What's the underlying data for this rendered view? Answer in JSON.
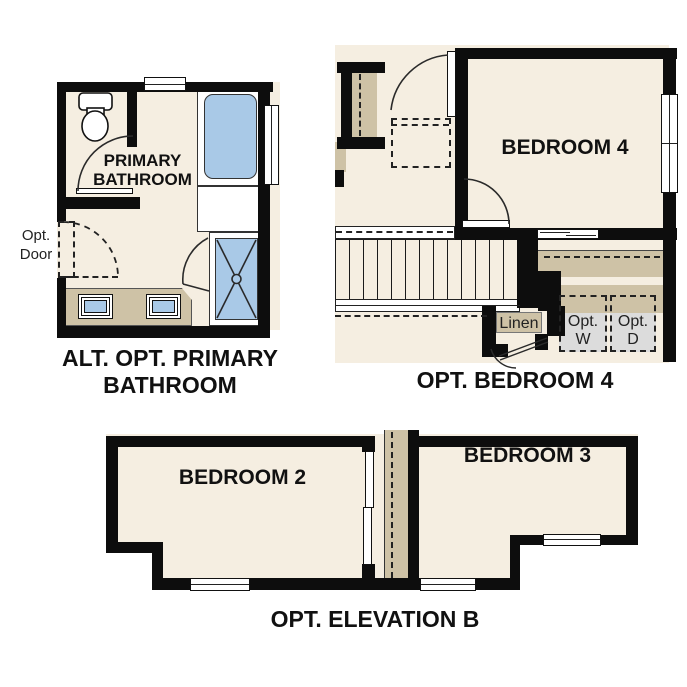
{
  "colors": {
    "floor_cream": "#f5eee1",
    "counter_tan": "#cec2a6",
    "fixture_blue": "#a9c9e7",
    "appliance_gray": "#dcdcdc",
    "wall_black": "#0d0d0d",
    "background": "#ffffff"
  },
  "bathroom_plan": {
    "room_label_line1": "PRIMARY",
    "room_label_line2": "BATHROOM",
    "opt_door_label_line1": "Opt.",
    "opt_door_label_line2": "Door",
    "caption_line1": "ALT. OPT. PRIMARY",
    "caption_line2": "BATHROOM"
  },
  "bedroom4_plan": {
    "room_label": "BEDROOM 4",
    "linen_label": "Linen",
    "washer_label_line1": "Opt.",
    "washer_label_line2": "W",
    "dryer_label_line1": "Opt.",
    "dryer_label_line2": "D",
    "caption": "OPT. BEDROOM 4"
  },
  "elevation_plan": {
    "bedroom2_label": "BEDROOM 2",
    "bedroom3_label": "BEDROOM 3",
    "caption": "OPT. ELEVATION B"
  }
}
